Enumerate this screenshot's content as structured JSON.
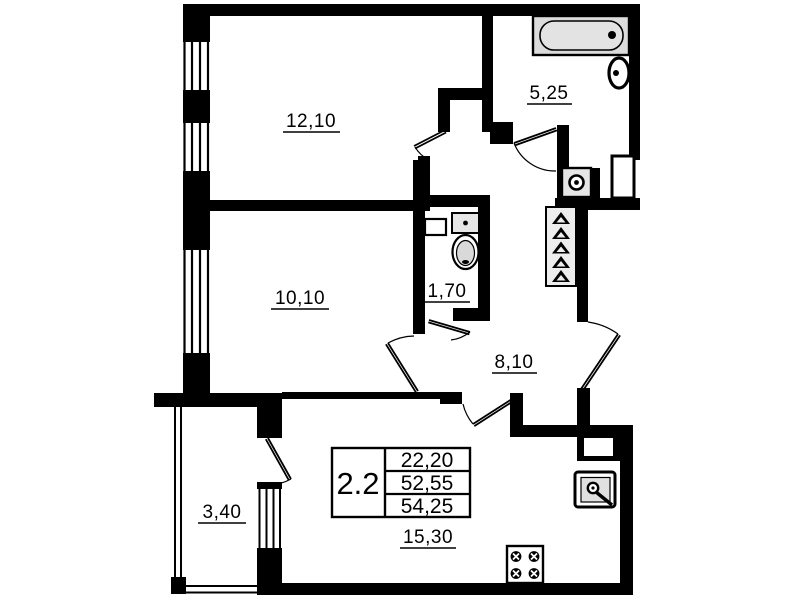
{
  "info_box": {
    "unit_label": "2.2",
    "rows": [
      "22,20",
      "52,55",
      "54,25"
    ]
  },
  "room_areas": {
    "top_left_room": "12,10",
    "bathroom": "5,25",
    "middle_left_room": "10,10",
    "wc": "1,70",
    "hallway": "8,10",
    "balcony": "3,40",
    "kitchen_living_room": "15,30"
  },
  "colors": {
    "wall": "#000000",
    "background": "#ffffff",
    "fixture_fill": "#e0e0e0"
  }
}
